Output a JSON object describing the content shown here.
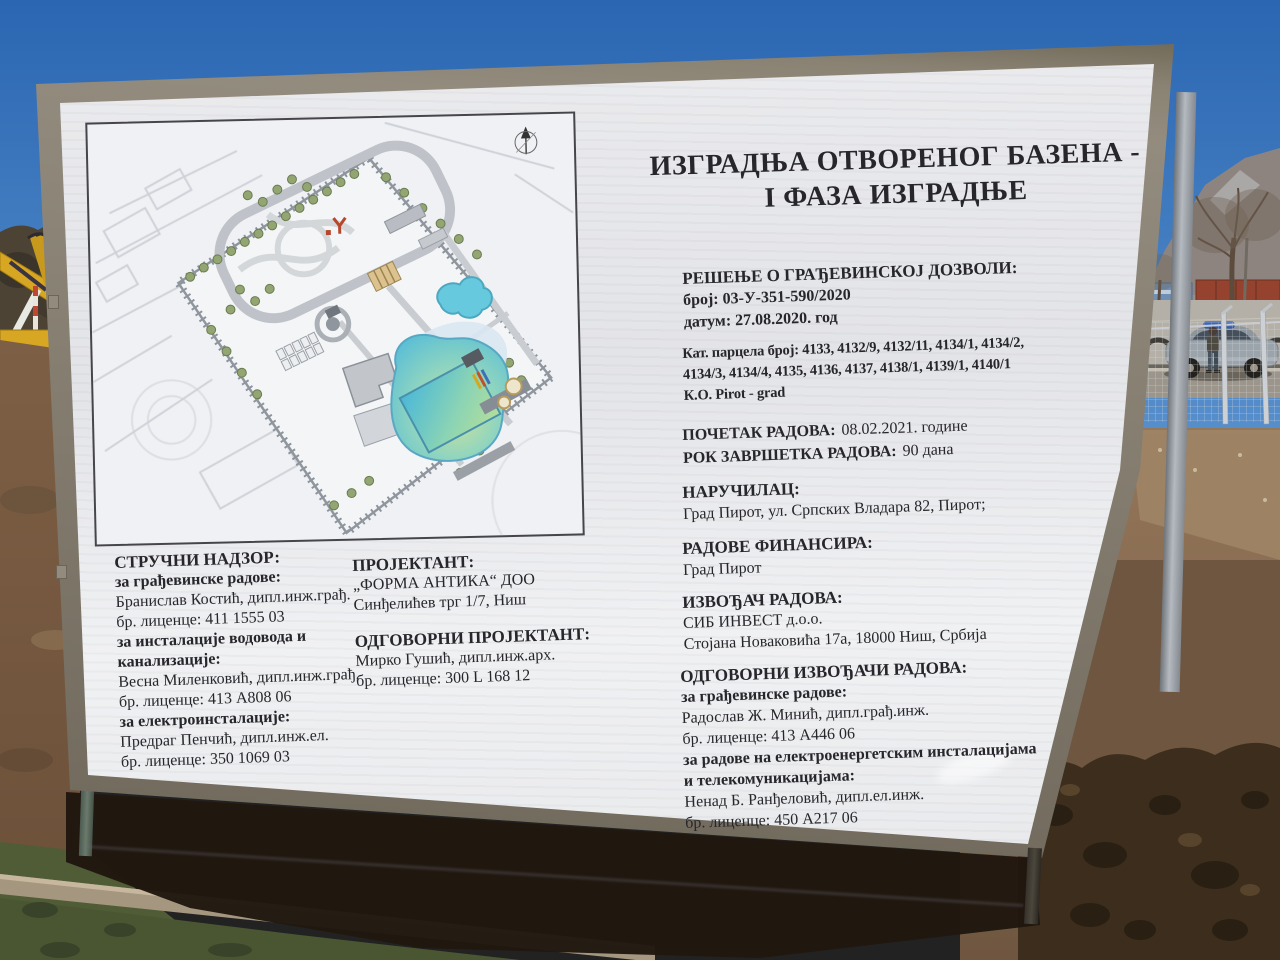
{
  "billboard": {
    "title": {
      "line1": "ИЗГРАДЊА ОТВОРЕНОГ БАЗЕНА -",
      "line2": "I ФАЗА ИЗГРАДЊЕ"
    },
    "permit": {
      "heading": "РЕШЕЊЕ О ГРАЂЕВИНСКОЈ ДОЗВОЛИ:",
      "number": "број: 03-У-351-590/2020",
      "date": "датум: 27.08.2020. год"
    },
    "parcels": {
      "line1": "Кат. парцела број: 4133, 4132/9, 4132/11, 4134/1, 4134/2,",
      "line2": "4134/3, 4134/4, 4135, 4136, 4137, 4138/1, 4139/1, 4140/1",
      "line3": "К.О. Pirot - grad"
    },
    "dates": {
      "start_label": "ПОЧЕТАК РАДОВА:",
      "start_value": "08.02.2021. године",
      "deadline_label": "РОК ЗАВРШЕТКА РАДОВА:",
      "deadline_value": "90 дана"
    },
    "client": {
      "heading": "НАРУЧИЛАЦ:",
      "value": "Град Пирот, ул. Српских Владара 82, Пирот;"
    },
    "financier": {
      "heading": "РАДОВЕ ФИНАНСИРА:",
      "value": "Град Пирот"
    },
    "contractor": {
      "heading": "ИЗВОЂАЧ РАДОВА:",
      "name": "СИБ ИНВЕСТ д.о.о.",
      "address": "Стојана Новаковића 17а, 18000 Ниш, Србија"
    },
    "responsible_contractors": {
      "heading": "ОДГОВОРНИ ИЗВОЂАЧИ РАДОВА:",
      "construction_label": "за грађевинске радове:",
      "construction_name": "Радослав Ж. Минић, дипл.грађ.инж.",
      "construction_license": "бр. лиценце: 413 А446 06",
      "electrical_label1": "за радове на електроенергетским инсталацијама",
      "electrical_label2": "и телекомуникацијама:",
      "electrical_name": "Ненад Б. Ранђеловић, дипл.ел.инж.",
      "electrical_license": "бр. лиценце: 450 А217 06"
    },
    "supervision": {
      "heading": "СТРУЧНИ НАДЗОР:",
      "construction_label": "за грађевинске радове:",
      "construction_name": "Бранислав Костић, дипл.инж.грађ.",
      "construction_license": "бр. лиценце: 411 1555 03",
      "plumbing_label1": "за инсталације водовода и",
      "plumbing_label2": "канализације:",
      "plumbing_name": "Весна Миленковић, дипл.инж.грађ.",
      "plumbing_license": "бр. лиценце: 413 А808 06",
      "electrical_label": "за електроинсталације:",
      "electrical_name": "Предраг Пенчић, дипл.инж.ел.",
      "electrical_license": "бр. лиценце: 350 1069 03"
    },
    "designer": {
      "heading": "ПРОЈЕКТАНТ:",
      "name": "„ФОРМА АНТИКА“ ДОО",
      "address": "Синђелићев трг 1/7, Ниш",
      "responsible_heading": "ОДГОВОРНИ ПРОЈЕКТАНТ:",
      "responsible_name": "Мирко Гушић, дипл.инж.арх.",
      "responsible_license": "бр. лиценце:  300 L 168 12"
    }
  },
  "colors": {
    "sky": "#2e6cb5",
    "board_white": "#e9eaec",
    "frame_metal": "#7d7668",
    "dirt": "#7b5d43",
    "pool_water": "#5fc3de",
    "excavator_yellow": "#d7a622",
    "grass": "#505c36",
    "text": "#26262b"
  }
}
